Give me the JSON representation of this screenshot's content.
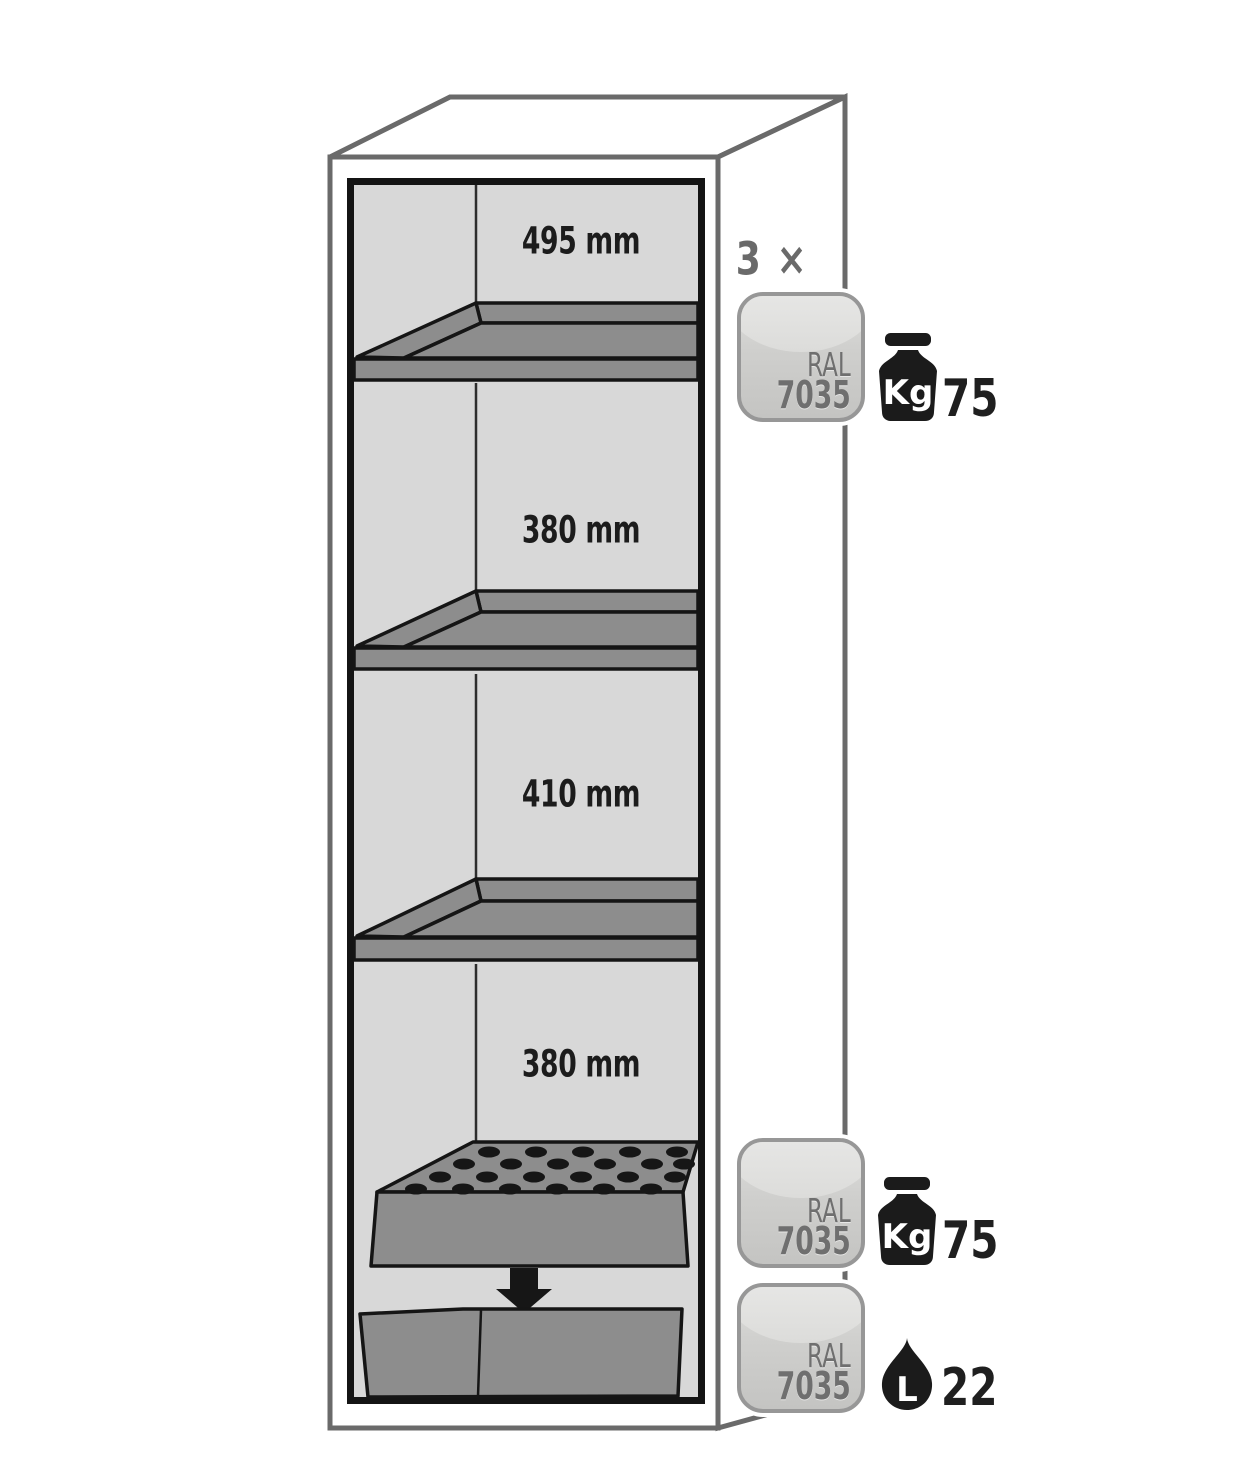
{
  "page": {
    "background": "#ffffff"
  },
  "cabinet": {
    "description": "safety cabinet interior with three shelves, perforated insert and bottom sump",
    "compartment_labels": [
      "495 mm",
      "380 mm",
      "410 mm",
      "380 mm"
    ]
  },
  "shelf_annotation": {
    "count": "3 ×",
    "ral_prefix": "RAL",
    "ral_code": "7035",
    "load": {
      "unit": "Kg",
      "value": "75"
    }
  },
  "insert_annotation": {
    "ral_prefix": "RAL",
    "ral_code": "7035",
    "load": {
      "unit": "Kg",
      "value": "75"
    }
  },
  "sump_annotation": {
    "ral_prefix": "RAL",
    "ral_code": "7035",
    "volume": {
      "unit": "L",
      "value": "22"
    }
  },
  "icons": {
    "weight": "weight-kg-icon",
    "volume": "liquid-drop-icon",
    "transfer": "down-arrow-icon"
  },
  "colors": {
    "outline_gray": "#6a6a6a",
    "frame_black": "#141414",
    "interior_gray": "#d8d8d8",
    "shelf_gray": "#8d8d8d",
    "badge_border": "#979797",
    "badge_fill_top": "#f1f1f0",
    "badge_fill_bottom": "#c4c4c2",
    "badge_text": "#6f6f6f",
    "label_text": "#1c1c1c",
    "icon_black": "#1b1b1b"
  }
}
